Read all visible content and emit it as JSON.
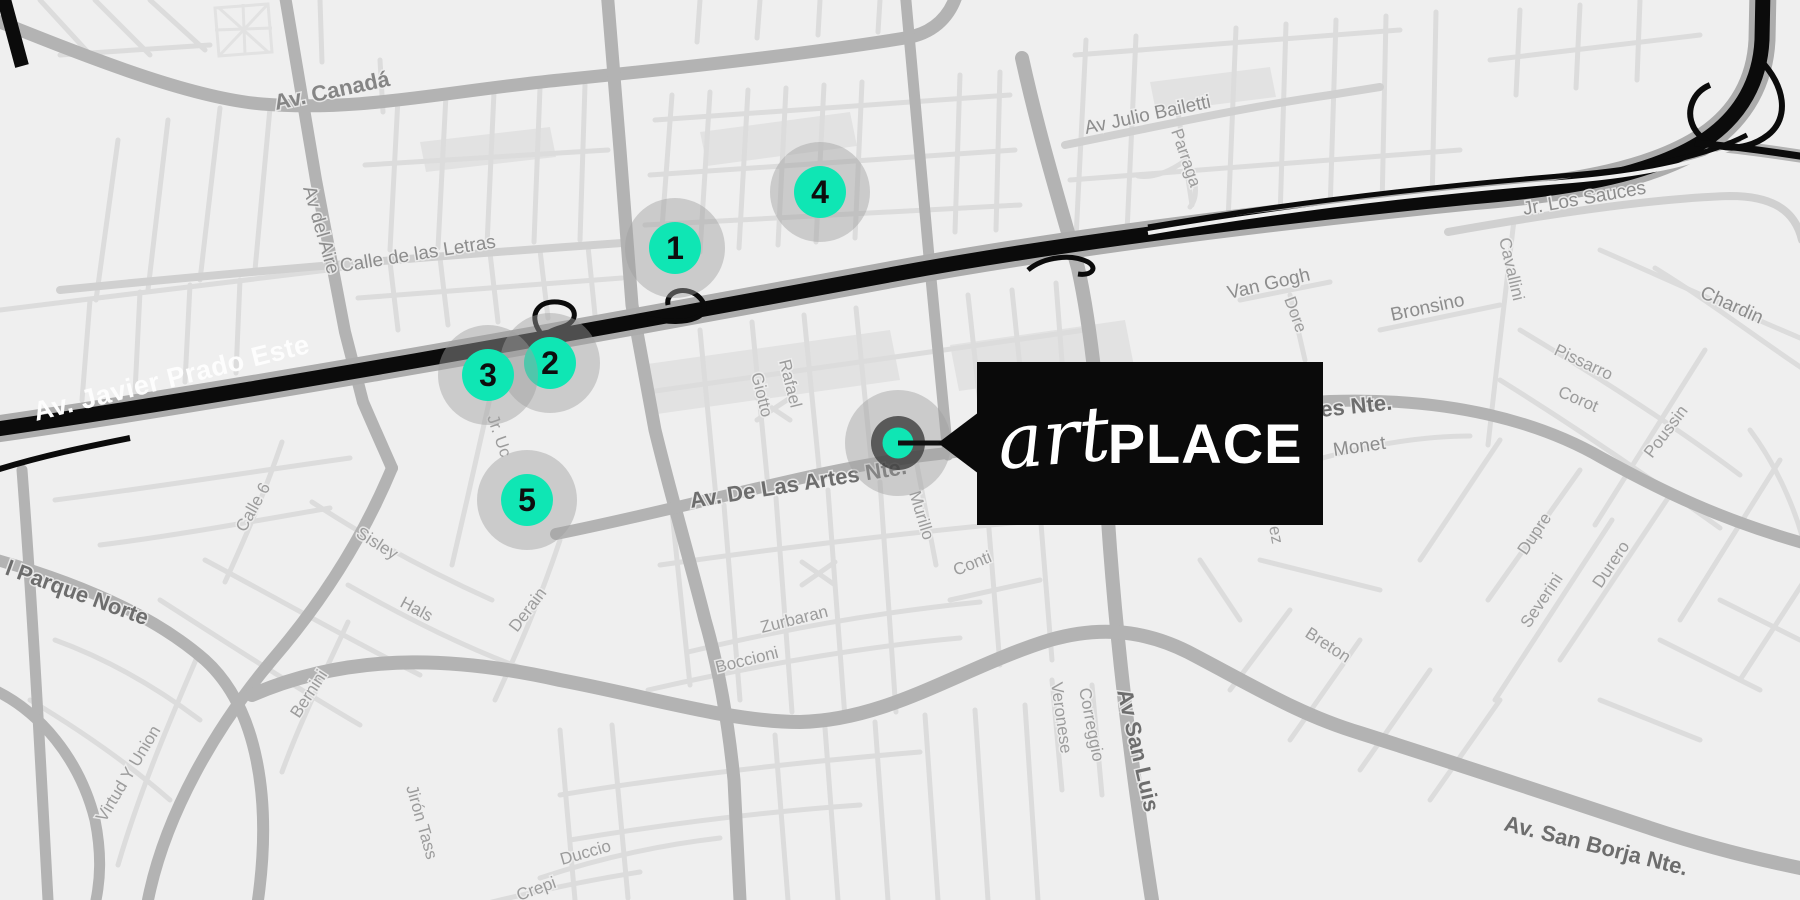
{
  "brand": {
    "script": "art",
    "bold": "PLACE"
  },
  "colors": {
    "accent": "#0FE6B4",
    "marker_number": "#0E0E0E",
    "marker_halo": "rgba(160,160,160,0.45)",
    "callout_bg": "#0A0A0A",
    "highway": "#0B0B0B",
    "road_major": "#B3B3B3",
    "road_minor": "#DCDCDC",
    "map_background": "#EFEFEF",
    "label_dark": "#6D6D6D",
    "label_light": "#9C9C9C",
    "highway_label": "#FDFDFD"
  },
  "destination": {
    "x": 898,
    "y": 443
  },
  "markers": [
    {
      "n": "1",
      "x": 675,
      "y": 248
    },
    {
      "n": "2",
      "x": 550,
      "y": 363
    },
    {
      "n": "3",
      "x": 488,
      "y": 375
    },
    {
      "n": "4",
      "x": 820,
      "y": 192
    },
    {
      "n": "5",
      "x": 527,
      "y": 500
    }
  ],
  "street_labels": [
    {
      "t": "Av. Canadá",
      "x": 276,
      "y": 110,
      "r": -12,
      "cls": "maj2"
    },
    {
      "t": "Av del Aire",
      "x": 303,
      "y": 188,
      "r": 74,
      "cls": "med"
    },
    {
      "t": "Calle de las Letras",
      "x": 341,
      "y": 272,
      "r": -9,
      "cls": "med"
    },
    {
      "t": "Av. Javier Prado Este",
      "x": 36,
      "y": 421,
      "r": -14,
      "cls": "hw"
    },
    {
      "t": "Av Julio Bailetti",
      "x": 1086,
      "y": 134,
      "r": -12,
      "cls": "med"
    },
    {
      "t": "Parraga",
      "x": 1171,
      "y": 131,
      "r": 71,
      "cls": "min"
    },
    {
      "t": "Van Gogh",
      "x": 1229,
      "y": 299,
      "r": -13,
      "cls": "med"
    },
    {
      "t": "Dore",
      "x": 1284,
      "y": 299,
      "r": 70,
      "cls": "min"
    },
    {
      "t": "Bronsino",
      "x": 1392,
      "y": 321,
      "r": -12,
      "cls": "med"
    },
    {
      "t": "Cavallini",
      "x": 1499,
      "y": 239,
      "r": 77,
      "cls": "min"
    },
    {
      "t": "Jr. Los Sauces",
      "x": 1524,
      "y": 215,
      "r": -10,
      "cls": "med"
    },
    {
      "t": "Chardin",
      "x": 1699,
      "y": 297,
      "r": 24,
      "cls": "med"
    },
    {
      "t": "Pissarro",
      "x": 1553,
      "y": 354,
      "r": 25,
      "cls": "min"
    },
    {
      "t": "Corot",
      "x": 1557,
      "y": 396,
      "r": 23,
      "cls": "min"
    },
    {
      "t": "Poussin",
      "x": 1652,
      "y": 459,
      "r": -53,
      "cls": "min"
    },
    {
      "t": "Monet",
      "x": 1334,
      "y": 456,
      "r": -8,
      "cls": "med"
    },
    {
      "t": "es Nte.",
      "x": 1321,
      "y": 417,
      "r": -6,
      "cls": "maj"
    },
    {
      "t": "Av. De Las Artes Nte.",
      "x": 691,
      "y": 508,
      "r": -9,
      "cls": "maj"
    },
    {
      "t": "Rafael",
      "x": 779,
      "y": 361,
      "r": 76,
      "cls": "min"
    },
    {
      "t": "Giotto",
      "x": 751,
      "y": 374,
      "r": 76,
      "cls": "min"
    },
    {
      "t": "Murillo",
      "x": 909,
      "y": 493,
      "r": 73,
      "cls": "min"
    },
    {
      "t": "Conti",
      "x": 956,
      "y": 576,
      "r": -22,
      "cls": "min"
    },
    {
      "t": "Zurbaran",
      "x": 762,
      "y": 633,
      "r": -14,
      "cls": "min"
    },
    {
      "t": "Boccioni",
      "x": 717,
      "y": 673,
      "r": -14,
      "cls": "min"
    },
    {
      "t": "Duccio",
      "x": 562,
      "y": 865,
      "r": -16,
      "cls": "min"
    },
    {
      "t": "Crepi",
      "x": 519,
      "y": 901,
      "r": -20,
      "cls": "min"
    },
    {
      "t": "Jirón Tass",
      "x": 406,
      "y": 787,
      "r": 74,
      "cls": "min"
    },
    {
      "t": "Sisley",
      "x": 355,
      "y": 536,
      "r": 32,
      "cls": "min"
    },
    {
      "t": "Hals",
      "x": 399,
      "y": 606,
      "r": 28,
      "cls": "min"
    },
    {
      "t": "Derain",
      "x": 517,
      "y": 633,
      "r": -53,
      "cls": "min"
    },
    {
      "t": "Bernini",
      "x": 299,
      "y": 719,
      "r": -57,
      "cls": "min"
    },
    {
      "t": "Calle 6",
      "x": 245,
      "y": 533,
      "r": -61,
      "cls": "min"
    },
    {
      "t": "Jr. Uc",
      "x": 487,
      "y": 417,
      "r": 71,
      "cls": "min"
    },
    {
      "t": "l Parque Norte",
      "x": 4,
      "y": 574,
      "r": 20,
      "cls": "maj"
    },
    {
      "t": "Virtud Y Union",
      "x": 105,
      "y": 823,
      "r": -59,
      "cls": "min"
    },
    {
      "t": "Av San Luis",
      "x": 1117,
      "y": 691,
      "r": 77,
      "cls": "maj"
    },
    {
      "t": "Veronese",
      "x": 1051,
      "y": 683,
      "r": 82,
      "cls": "min"
    },
    {
      "t": "Correggio",
      "x": 1079,
      "y": 689,
      "r": 79,
      "cls": "min"
    },
    {
      "t": "Breton",
      "x": 1304,
      "y": 636,
      "r": 33,
      "cls": "min"
    },
    {
      "t": "Av. San Borja Nte.",
      "x": 1503,
      "y": 830,
      "r": 14,
      "cls": "maj"
    },
    {
      "t": "Severini",
      "x": 1529,
      "y": 629,
      "r": -56,
      "cls": "min"
    },
    {
      "t": "Dupre",
      "x": 1526,
      "y": 556,
      "r": -56,
      "cls": "min"
    },
    {
      "t": "Durero",
      "x": 1601,
      "y": 589,
      "r": -56,
      "cls": "min"
    },
    {
      "t": "ez",
      "x": 1269,
      "y": 527,
      "r": 79,
      "cls": "min"
    }
  ]
}
